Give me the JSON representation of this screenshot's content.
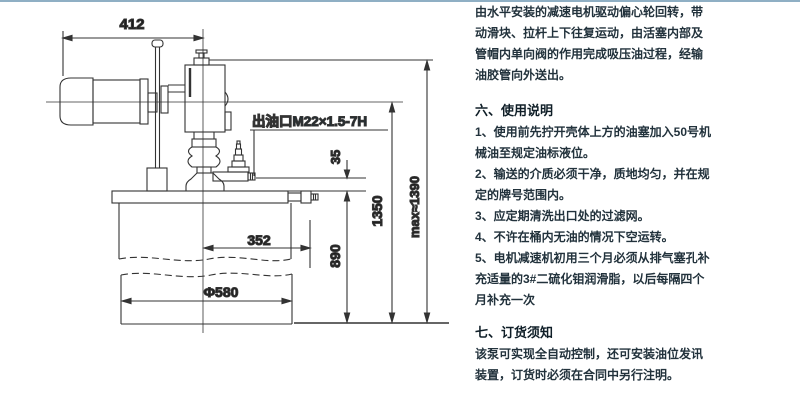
{
  "page": {
    "background": "#ffffff",
    "top_border_color": "#8fafc4"
  },
  "right_column": {
    "intro_lines": [
      "由水平安装的减速电机驱动偏心轮回转，带",
      "动滑块、拉杆上下往复运动，由活塞内部及",
      "管帽内单向阀的作用完成吸压油过程，经输",
      "油胶管向外送出。"
    ],
    "section6": {
      "heading": "六、使用说明",
      "lines": [
        "1、使用前先拧开壳体上方的油塞加入50号机",
        "械油至规定油标液位。",
        "2、输送的介质必须干净，质地均匀，并在规",
        "定的牌号范围内。",
        "3、应定期清洗出口处的过滤网。",
        "4、不许在桶内无油的情况下空运转。",
        "5、电机减速机初用三个月必须从排气塞孔补",
        "充适量的3#二硫化钼润滑脂，以后每隔四个",
        "月补充一次"
      ]
    },
    "section7": {
      "heading": "七、订货须知",
      "lines": [
        "该泵可实现全自动控制，还可安装油位发讯",
        "装置，订货时必须在合同中另行注明。"
      ]
    }
  },
  "drawing": {
    "line_color": "#333333",
    "labels": {
      "outlet_port": "出油口M22×1.5-7H",
      "width_412": "412",
      "offset_35": "35",
      "radius_352": "352",
      "height_890": "890",
      "height_1350": "1350",
      "height_max": "max≈1390",
      "barrel_diameter": "Φ580"
    }
  }
}
